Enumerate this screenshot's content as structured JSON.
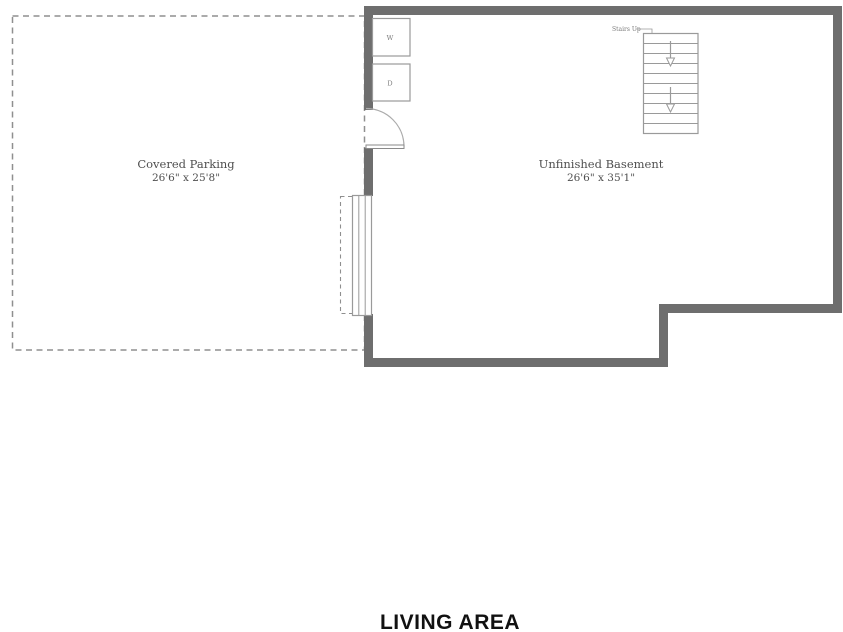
{
  "plan": {
    "title": "LIVING AREA",
    "rooms": [
      {
        "name": "Covered Parking",
        "dimensions": "26'6\" x 25'8\""
      },
      {
        "name": "Unfinished Basement",
        "dimensions": "26'6\" x 35'1\""
      }
    ],
    "stairs_label": "Stairs Up",
    "appliances": {
      "washer": "W",
      "dryer": "D"
    }
  },
  "colors": {
    "wall": "#6e6e6e",
    "outline": "#9a9a9a",
    "dashed": "#8f8f8f",
    "label": "#4f4f4f",
    "tiny": "#7a7a7a",
    "title": "#111111",
    "bg": "#ffffff"
  }
}
